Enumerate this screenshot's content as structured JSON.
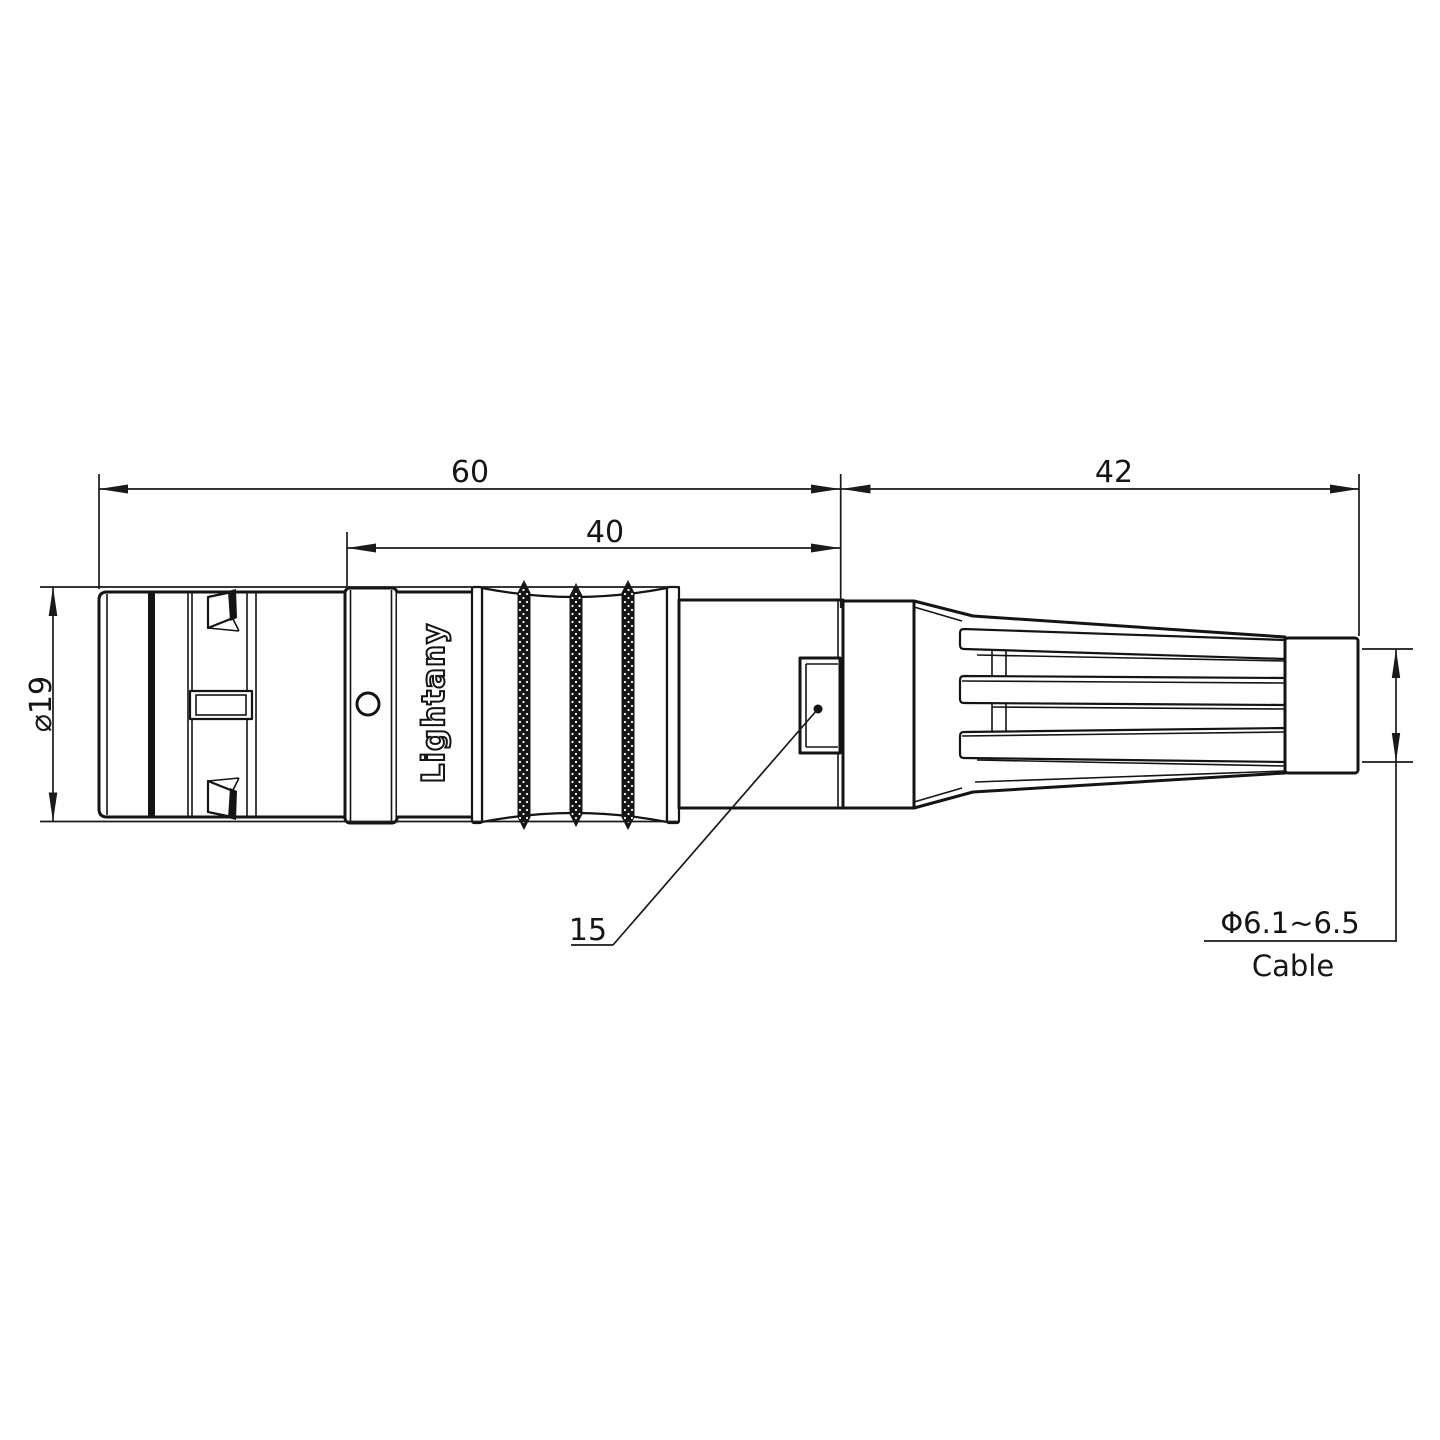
{
  "page": {
    "background": "#ffffff"
  },
  "drawing": {
    "type": "technical-drawing",
    "part": "circular push-pull cable connector with strain relief boot",
    "brand_engraving": "Lightany",
    "watermark": "Lightany",
    "dimensions": {
      "overall_front_length": "60",
      "mid_section_length": "40",
      "boot_length": "42",
      "shell_diameter": "⌀19",
      "backnut_ref": "15",
      "cable_diameter_range": "Φ6.1~6.5",
      "cable_label": "Cable"
    },
    "colors": {
      "line": "#141414",
      "watermark_pink": "#e07a7a"
    }
  }
}
